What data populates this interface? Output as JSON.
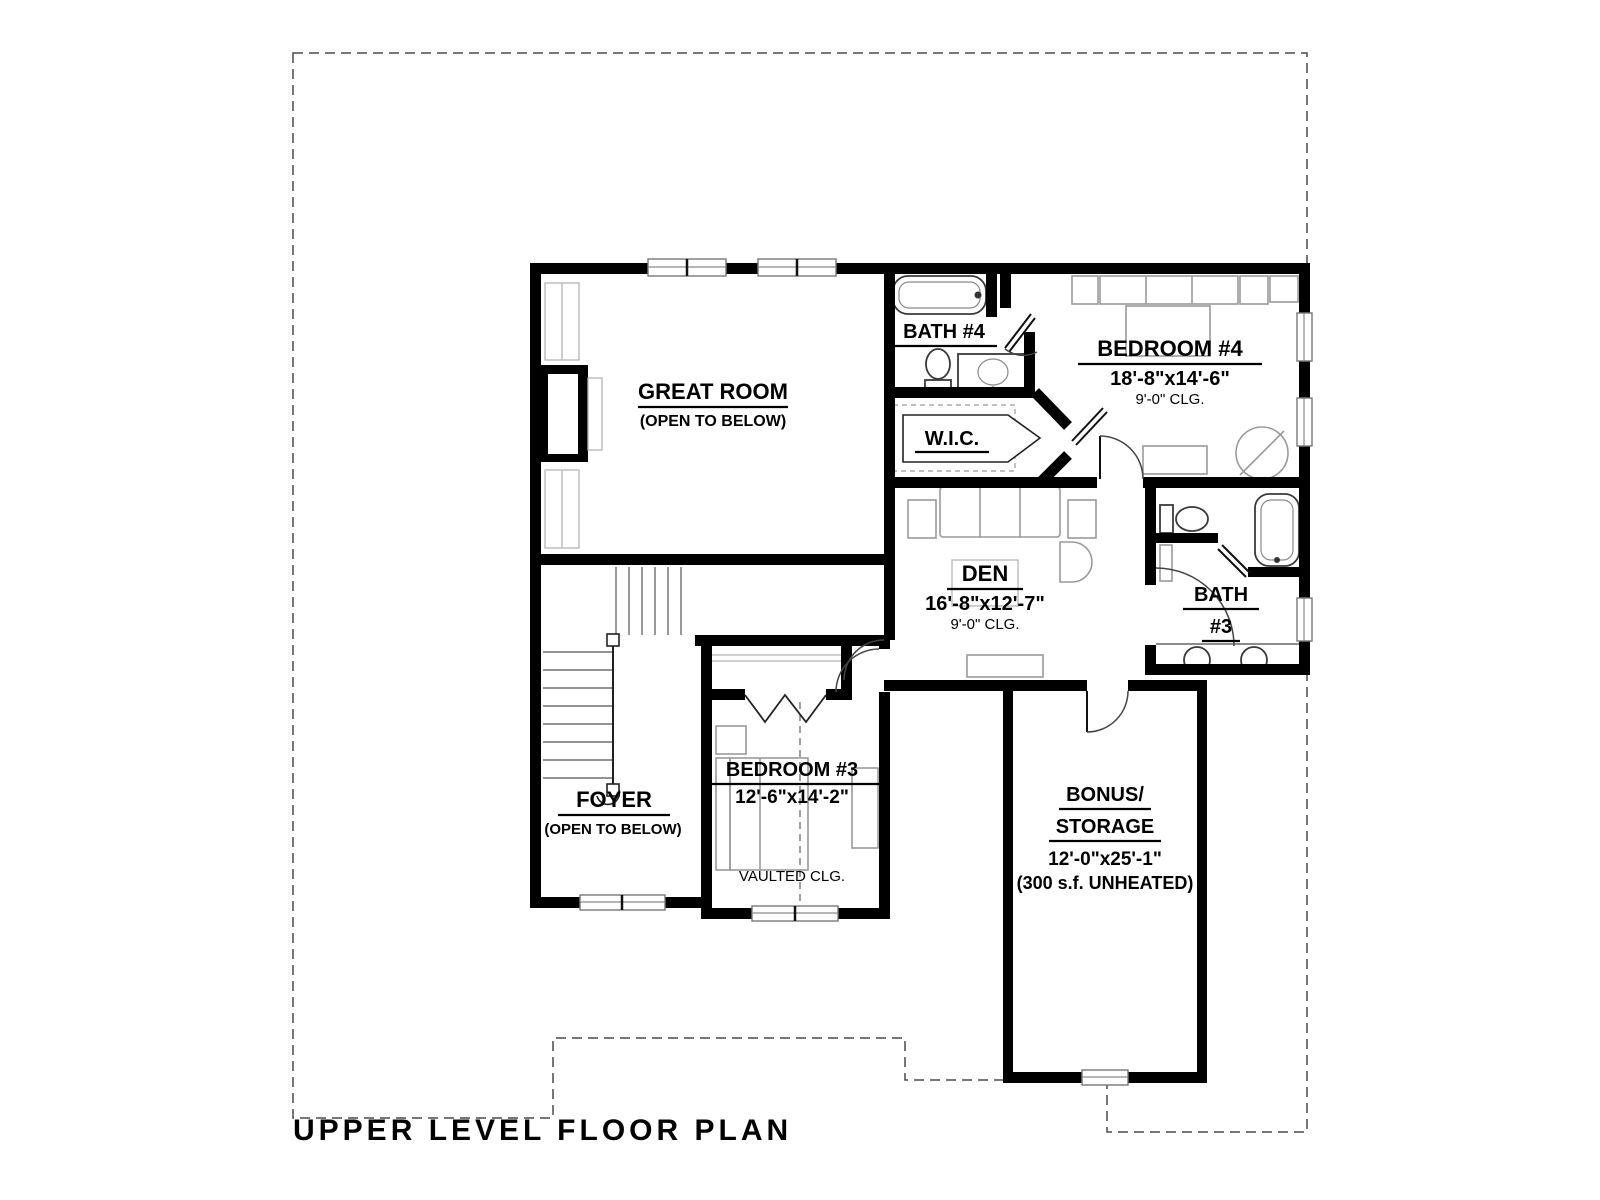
{
  "title": "UPPER LEVEL FLOOR PLAN",
  "rooms": {
    "great_room": {
      "name": "GREAT ROOM",
      "note": "(OPEN TO BELOW)"
    },
    "bath_4": {
      "name": "BATH #4"
    },
    "bedroom_4": {
      "name": "BEDROOM #4",
      "dimensions": "18'-8\"x14'-6\"",
      "ceiling": "9'-0\" CLG."
    },
    "wic": {
      "name": "W.I.C."
    },
    "den": {
      "name": "DEN",
      "dimensions": "16'-8\"x12'-7\"",
      "ceiling": "9'-0\" CLG."
    },
    "bath_3": {
      "name_line_1": "BATH",
      "name_line_2": "#3"
    },
    "foyer": {
      "name": "FOYER",
      "note": "(OPEN TO BELOW)"
    },
    "bedroom_3": {
      "name": "BEDROOM #3",
      "dimensions": "12'-6\"x14'-2\"",
      "ceiling": "VAULTED CLG."
    },
    "bonus_storage": {
      "name_line_1": "BONUS/",
      "name_line_2": "STORAGE",
      "dimensions": "12'-0\"x25'-1\"",
      "note": "(300 s.f. UNHEATED)"
    }
  },
  "colors": {
    "wall": "#000000",
    "fixture_stroke": "#3a3a3a",
    "furniture_stroke": "#9a9a9a",
    "roof_outline_dash": "#4a4a4a",
    "background": "#ffffff"
  }
}
